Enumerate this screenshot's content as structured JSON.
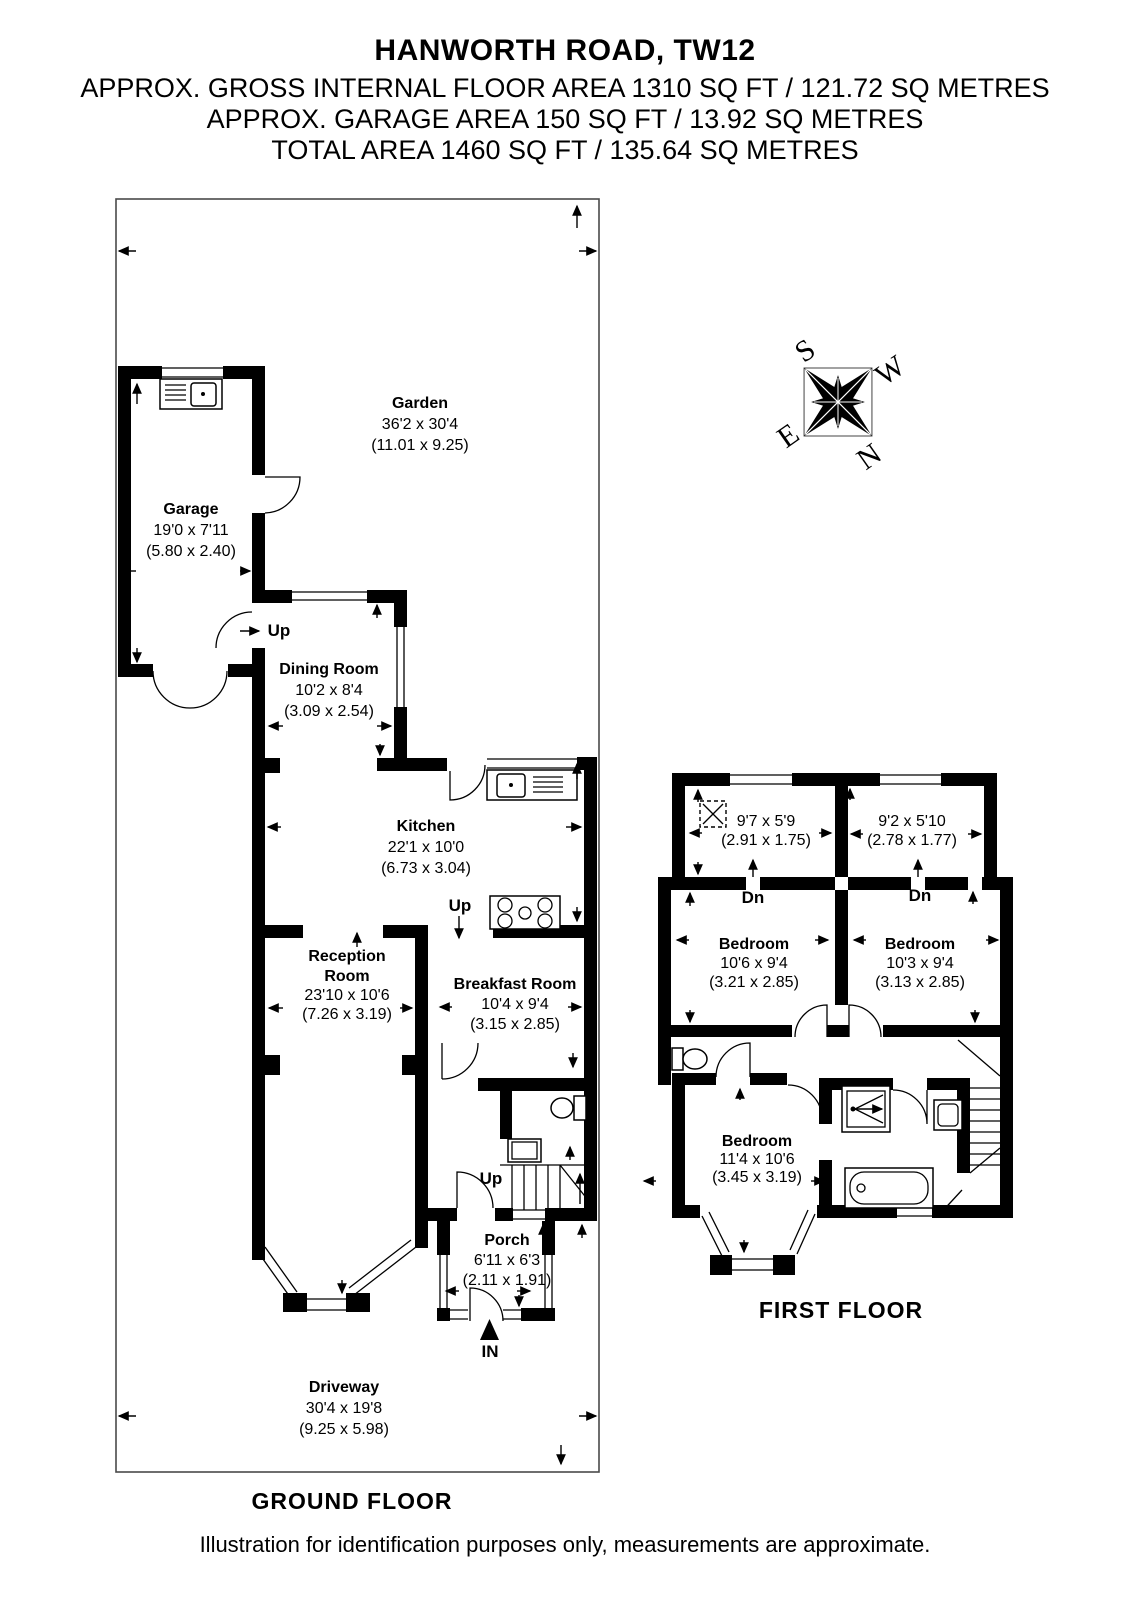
{
  "header": {
    "title": "HANWORTH ROAD, TW12",
    "area_line1": "APPROX. GROSS INTERNAL FLOOR AREA 1310 SQ FT / 121.72 SQ METRES",
    "area_line2": "APPROX. GARAGE AREA 150 SQ FT / 13.92 SQ METRES",
    "area_line3": "TOTAL AREA 1460 SQ FT / 135.64 SQ METRES"
  },
  "floors": {
    "ground_label": "GROUND FLOOR",
    "first_label": "FIRST FLOOR"
  },
  "compass": {
    "n": "N",
    "s": "S",
    "e": "E",
    "w": "W"
  },
  "rooms": {
    "garden": {
      "name": "Garden",
      "imperial": "36'2 x 30'4",
      "metric": "(11.01 x 9.25)"
    },
    "garage": {
      "name": "Garage",
      "imperial": "19'0 x 7'11",
      "metric": "(5.80 x 2.40)"
    },
    "dining_room": {
      "name": "Dining Room",
      "imperial": "10'2 x 8'4",
      "metric": "(3.09 x 2.54)"
    },
    "kitchen": {
      "name": "Kitchen",
      "imperial": "22'1 x 10'0",
      "metric": "(6.73 x 3.04)"
    },
    "breakfast_room": {
      "name": "Breakfast Room",
      "imperial": "10'4 x 9'4",
      "metric": "(3.15 x 2.85)"
    },
    "reception_room": {
      "name_line1": "Reception",
      "name_line2": "Room",
      "imperial": "23'10 x 10'6",
      "metric": "(7.26 x 3.19)"
    },
    "porch": {
      "name": "Porch",
      "imperial": "6'11 x 6'3",
      "metric": "(2.11 x 1.91)"
    },
    "driveway": {
      "name": "Driveway",
      "imperial": "30'4 x 19'8",
      "metric": "(9.25 x 5.98)"
    },
    "loft_left": {
      "imperial": "9'7 x 5'9",
      "metric": "(2.91 x 1.75)"
    },
    "loft_right": {
      "imperial": "9'2 x 5'10",
      "metric": "(2.78 x 1.77)"
    },
    "bedroom1": {
      "name": "Bedroom",
      "imperial": "10'6 x 9'4",
      "metric": "(3.21 x 2.85)"
    },
    "bedroom2": {
      "name": "Bedroom",
      "imperial": "10'3 x 9'4",
      "metric": "(3.13 x 2.85)"
    },
    "bedroom3": {
      "name": "Bedroom",
      "imperial": "11'4 x 10'6",
      "metric": "(3.45 x 3.19)"
    }
  },
  "annotations": {
    "up": "Up",
    "dn": "Dn",
    "in": "IN"
  },
  "footer": {
    "disclaimer": "Illustration for identification purposes only, measurements are approximate."
  },
  "colors": {
    "wall": "#000000",
    "background": "#ffffff",
    "boundary": "#4a4a4a"
  }
}
